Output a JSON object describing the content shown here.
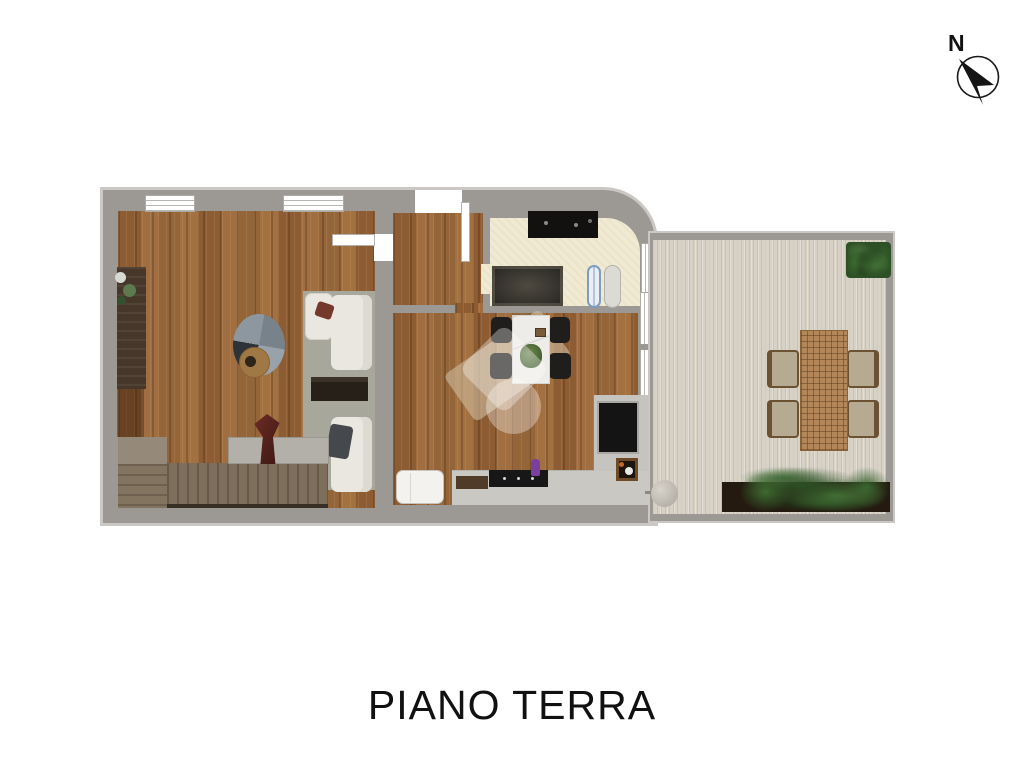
{
  "title": "PIANO TERRA",
  "compass": {
    "label": "N"
  },
  "palette": {
    "background": "#ffffff",
    "wall": "#9c9893",
    "wall_outline": "#cbc7c4",
    "wood_floor": "#9a6a3e",
    "bathroom_floor": "#f0ead3",
    "terrace_floor": "#d7d1c6",
    "area_rug": "#a8a79c",
    "sofa_cream": "#e9e7e0",
    "kitchen_counter": "#cac8c3",
    "appliance_black": "#141414",
    "plant_green": "#3c6a30",
    "rattan": "#b3875a",
    "stairs": "#7e6f5c",
    "vase_red": "#5e2420",
    "title_text": "#111111",
    "watermark": "rgba(255,255,255,0.33)"
  },
  "furniture_icons": [
    "sideboard",
    "plant-decor",
    "round-rug",
    "stool",
    "sofa-pair",
    "coffee-table",
    "staircase",
    "console-table",
    "red-vase",
    "dining-table",
    "dining-chairs",
    "kitchen-counter",
    "cooktop",
    "cutting-board",
    "fridge",
    "sink-basin",
    "washing-machine",
    "bath-vanity",
    "ornate-rug",
    "surfboards",
    "outdoor-dining-table",
    "outdoor-chairs",
    "planter-box",
    "garden-pot",
    "hedge"
  ]
}
